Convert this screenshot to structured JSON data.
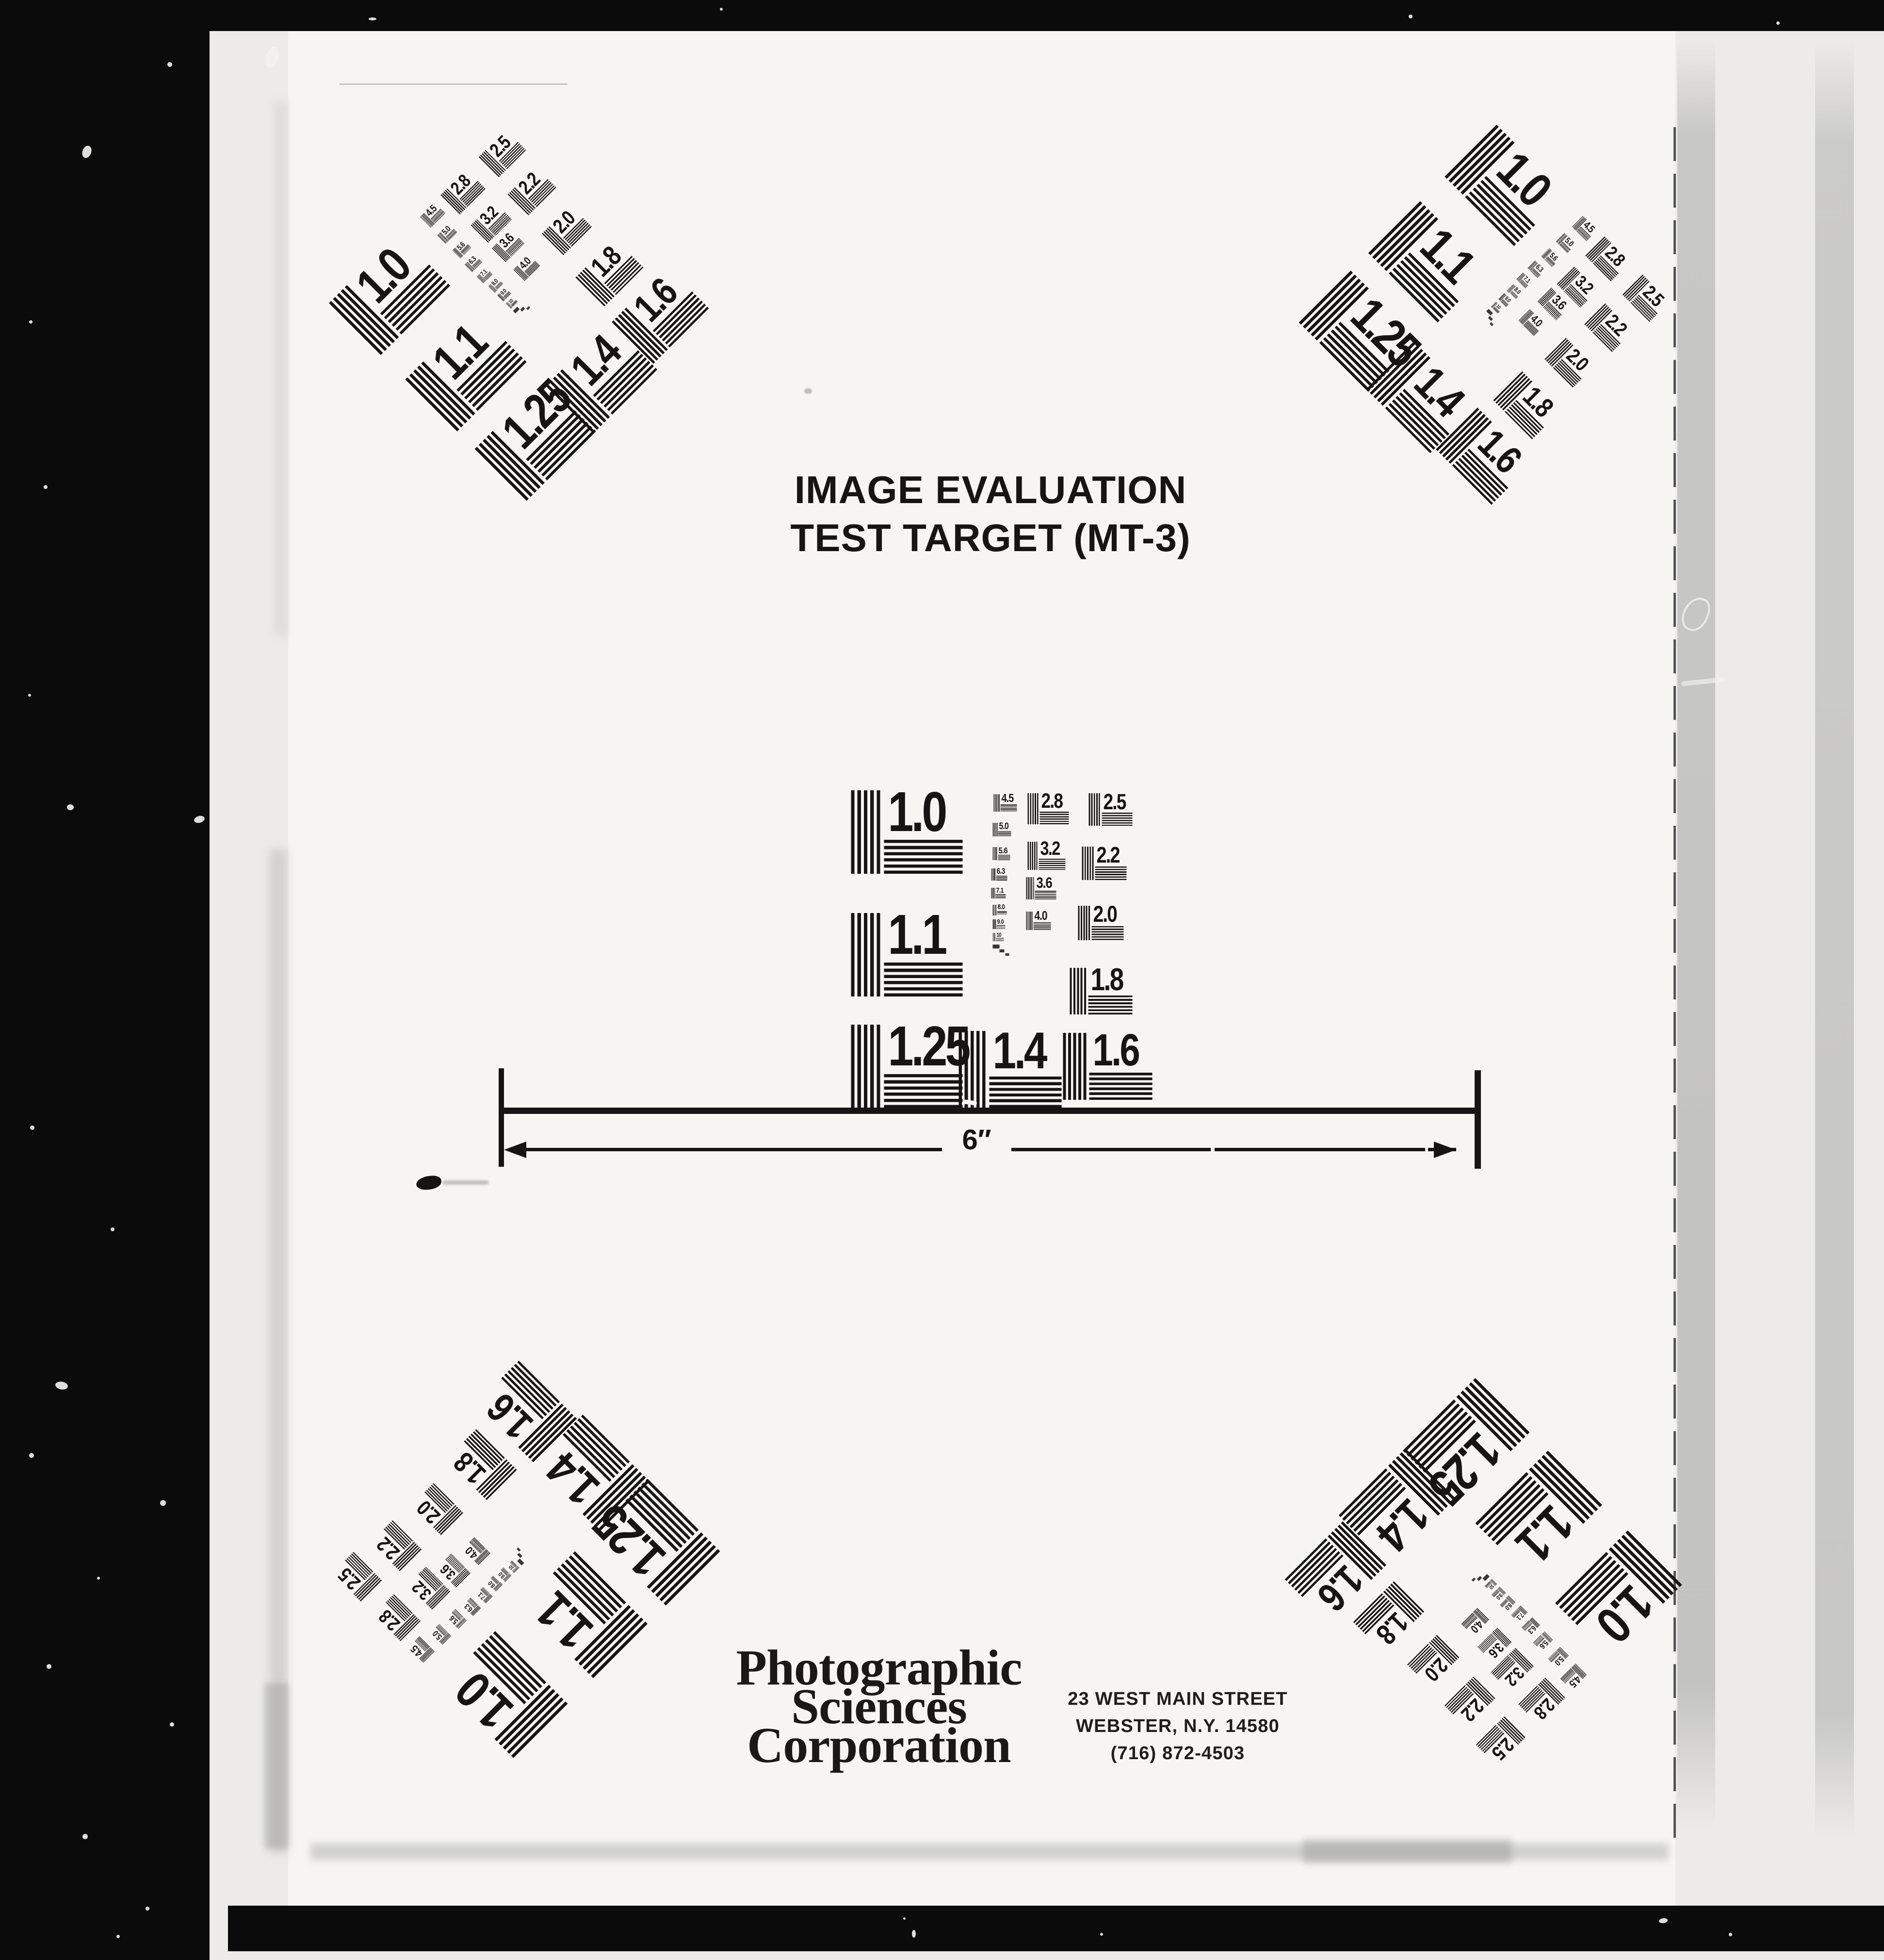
{
  "document_kind": "Image evaluation test target scan",
  "header": {
    "title_line1": "IMAGE EVALUATION",
    "title_line2": "TEST TARGET (MT-3)"
  },
  "ruler": {
    "length_label": "6″"
  },
  "footer": {
    "company_lines": [
      "Photographic",
      "Sciences",
      "Corporation"
    ],
    "address_lines": [
      "23 WEST MAIN STREET",
      "WEBSTER, N.Y. 14580",
      "(716) 872-4503"
    ]
  },
  "test_pattern": {
    "blocks": [
      {
        "label": "1.0"
      },
      {
        "label": "1.1"
      },
      {
        "label": "1.25"
      },
      {
        "label": "1.4"
      },
      {
        "label": "1.6"
      },
      {
        "label": "1.8"
      },
      {
        "label": "2.0"
      },
      {
        "label": "2.2"
      },
      {
        "label": "2.5"
      },
      {
        "label": "2.8"
      },
      {
        "label": "3.2"
      },
      {
        "label": "3.6"
      },
      {
        "label": "4.0"
      },
      {
        "label": "4.5"
      },
      {
        "label": "5.0"
      },
      {
        "label": "5.6"
      },
      {
        "label": "6.3"
      },
      {
        "label": "7.1"
      },
      {
        "label": "8.0"
      },
      {
        "label": "9.0"
      },
      {
        "label": "10"
      }
    ],
    "instances": [
      "center",
      "top-left",
      "top-right",
      "bottom-left",
      "bottom-right"
    ]
  },
  "colors": {
    "film_black": "#0b0b0b",
    "page_white": "#f6f5f2",
    "backing_white": "#ecebe8",
    "strip_gray": "#c5c5c3",
    "ink_black": "#171513"
  }
}
